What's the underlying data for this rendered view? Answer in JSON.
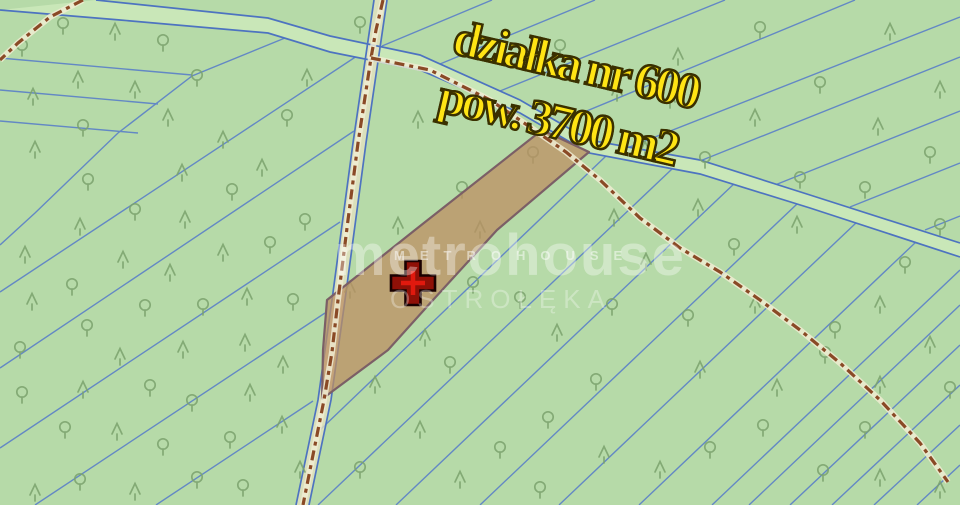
{
  "canvas": {
    "width": 960,
    "height": 505
  },
  "labels": {
    "parcel_number": "działka nr 600",
    "parcel_area": "pow. 3700 m2"
  },
  "watermark": {
    "brand": "metrohouse",
    "brand_small": "METROHOUSE",
    "city": "OSTROŁĘKA"
  },
  "colors": {
    "ground": "#b6daa8",
    "boundary_line": "#5b80c8",
    "road_edge": "#4d73c0",
    "road_fill": "#c9e7b8",
    "path_fill": "#e6e2c2",
    "dash_backing": "#f0ecd2",
    "dash": "#8a4a26",
    "tree": "#7ba26d",
    "parcel_fill": "#bc8f63",
    "parcel_border": "#7b5f66",
    "marker_fill": "#8f1007",
    "marker_inner": "#e0190e",
    "marker_outline": "#190000",
    "label_yellow": "#ffe414",
    "label_outline": "#3a3000"
  },
  "map": {
    "boundary_lines": [
      [
        [
          0,
          58
        ],
        [
          192,
          75
        ]
      ],
      [
        [
          0,
          90
        ],
        [
          158,
          104
        ]
      ],
      [
        [
          0,
          121
        ],
        [
          138,
          133
        ]
      ],
      [
        [
          285,
          38
        ],
        [
          192,
          76
        ],
        [
          118,
          133
        ],
        [
          35,
          213
        ],
        [
          0,
          245
        ]
      ],
      [
        [
          366,
          50
        ],
        [
          0,
          292
        ]
      ],
      [
        [
          354,
          131
        ],
        [
          0,
          368
        ]
      ],
      [
        [
          340,
          222
        ],
        [
          0,
          448
        ]
      ],
      [
        [
          325,
          313
        ],
        [
          35,
          505
        ]
      ],
      [
        [
          313,
          401
        ],
        [
          156,
          505
        ]
      ],
      [
        [
          606,
          156
        ],
        [
          320,
          430
        ]
      ],
      [
        [
          672,
          169
        ],
        [
          318,
          505
        ]
      ],
      [
        [
          737,
          181
        ],
        [
          396,
          505
        ]
      ],
      [
        [
          797,
          204
        ],
        [
          480,
          505
        ]
      ],
      [
        [
          857,
          222
        ],
        [
          559,
          505
        ]
      ],
      [
        [
          917,
          241
        ],
        [
          639,
          505
        ]
      ],
      [
        [
          960,
          270
        ],
        [
          712,
          505
        ]
      ],
      [
        [
          960,
          305
        ],
        [
          749,
          505
        ]
      ],
      [
        [
          960,
          345
        ],
        [
          790,
          505
        ]
      ],
      [
        [
          960,
          385
        ],
        [
          832,
          505
        ]
      ],
      [
        [
          960,
          425
        ],
        [
          874,
          505
        ]
      ],
      [
        [
          960,
          465
        ],
        [
          917,
          505
        ]
      ],
      [
        [
          382,
          46
        ],
        [
          492,
          0
        ]
      ],
      [
        [
          440,
          64
        ],
        [
          595,
          0
        ]
      ],
      [
        [
          500,
          91
        ],
        [
          725,
          0
        ]
      ],
      [
        [
          560,
          122
        ],
        [
          855,
          0
        ]
      ],
      [
        [
          627,
          148
        ],
        [
          960,
          17
        ]
      ],
      [
        [
          700,
          161
        ],
        [
          960,
          57
        ]
      ],
      [
        [
          775,
          185
        ],
        [
          960,
          111
        ]
      ],
      [
        [
          850,
          207
        ],
        [
          960,
          163
        ]
      ],
      [
        [
          925,
          230
        ],
        [
          960,
          216
        ]
      ]
    ],
    "roads": {
      "main": {
        "upper": [
          [
            96,
            0
          ],
          [
            268,
            18
          ],
          [
            330,
            36
          ],
          [
            420,
            55
          ],
          [
            520,
            100
          ],
          [
            589,
            140
          ],
          [
            700,
            160
          ],
          [
            810,
            195
          ],
          [
            960,
            243
          ]
        ],
        "lower": [
          [
            0,
            10
          ],
          [
            120,
            20
          ],
          [
            268,
            33
          ],
          [
            330,
            52
          ],
          [
            420,
            70
          ],
          [
            520,
            113
          ],
          [
            589,
            153
          ],
          [
            700,
            174
          ],
          [
            810,
            208
          ],
          [
            960,
            257
          ]
        ]
      },
      "path": {
        "left": [
          [
            374,
            0
          ],
          [
            353,
            143
          ],
          [
            332,
            300
          ],
          [
            318,
            400
          ],
          [
            296,
            505
          ]
        ],
        "right": [
          [
            387,
            0
          ],
          [
            366,
            143
          ],
          [
            345,
            300
          ],
          [
            331,
            400
          ],
          [
            309,
            505
          ]
        ]
      }
    },
    "dashed_paths": [
      [
        [
          383,
          0
        ],
        [
          376,
          30
        ],
        [
          371,
          58
        ],
        [
          358,
          143
        ],
        [
          348,
          220
        ],
        [
          338,
          300
        ],
        [
          332,
          352
        ],
        [
          324,
          400
        ],
        [
          312,
          460
        ],
        [
          303,
          505
        ]
      ],
      [
        [
          371,
          58
        ],
        [
          430,
          70
        ],
        [
          490,
          100
        ],
        [
          530,
          127
        ],
        [
          566,
          152
        ],
        [
          600,
          180
        ],
        [
          640,
          218
        ],
        [
          680,
          248
        ],
        [
          720,
          272
        ],
        [
          760,
          300
        ],
        [
          800,
          330
        ],
        [
          840,
          363
        ],
        [
          880,
          400
        ],
        [
          920,
          443
        ],
        [
          948,
          482
        ]
      ],
      [
        [
          83,
          0
        ],
        [
          50,
          17
        ],
        [
          18,
          43
        ],
        [
          0,
          60
        ]
      ]
    ],
    "parcel": {
      "points": [
        [
          542,
          130
        ],
        [
          589,
          152
        ],
        [
          497,
          230
        ],
        [
          433,
          300
        ],
        [
          388,
          350
        ],
        [
          322,
          399
        ],
        [
          323,
          350
        ],
        [
          327,
          300
        ],
        [
          415,
          230
        ]
      ],
      "marker": {
        "x": 413,
        "y": 283
      }
    },
    "trees": [
      [
        115,
        32,
        "c"
      ],
      [
        163,
        43,
        "d"
      ],
      [
        22,
        48,
        "d"
      ],
      [
        63,
        26,
        "d"
      ],
      [
        78,
        80,
        "c"
      ],
      [
        33,
        97,
        "c"
      ],
      [
        135,
        90,
        "c"
      ],
      [
        197,
        78,
        "d"
      ],
      [
        83,
        128,
        "d"
      ],
      [
        168,
        118,
        "c"
      ],
      [
        35,
        150,
        "c"
      ],
      [
        223,
        140,
        "c"
      ],
      [
        182,
        173,
        "c"
      ],
      [
        88,
        182,
        "d"
      ],
      [
        135,
        212,
        "d"
      ],
      [
        232,
        192,
        "d"
      ],
      [
        80,
        227,
        "c"
      ],
      [
        185,
        220,
        "c"
      ],
      [
        287,
        118,
        "d"
      ],
      [
        262,
        168,
        "c"
      ],
      [
        305,
        222,
        "d"
      ],
      [
        307,
        78,
        "c"
      ],
      [
        360,
        25,
        "d"
      ],
      [
        25,
        255,
        "c"
      ],
      [
        123,
        260,
        "c"
      ],
      [
        170,
        273,
        "c"
      ],
      [
        72,
        287,
        "d"
      ],
      [
        223,
        253,
        "c"
      ],
      [
        270,
        245,
        "d"
      ],
      [
        32,
        302,
        "c"
      ],
      [
        145,
        308,
        "d"
      ],
      [
        203,
        307,
        "d"
      ],
      [
        247,
        297,
        "c"
      ],
      [
        293,
        302,
        "d"
      ],
      [
        87,
        328,
        "d"
      ],
      [
        120,
        357,
        "c"
      ],
      [
        183,
        350,
        "c"
      ],
      [
        245,
        343,
        "c"
      ],
      [
        20,
        350,
        "d"
      ],
      [
        22,
        395,
        "d"
      ],
      [
        83,
        390,
        "c"
      ],
      [
        150,
        388,
        "d"
      ],
      [
        192,
        403,
        "d"
      ],
      [
        250,
        393,
        "c"
      ],
      [
        283,
        365,
        "c"
      ],
      [
        65,
        430,
        "d"
      ],
      [
        117,
        432,
        "c"
      ],
      [
        163,
        447,
        "d"
      ],
      [
        230,
        440,
        "d"
      ],
      [
        282,
        425,
        "c"
      ],
      [
        35,
        493,
        "c"
      ],
      [
        80,
        482,
        "d"
      ],
      [
        135,
        492,
        "c"
      ],
      [
        197,
        480,
        "d"
      ],
      [
        243,
        488,
        "d"
      ],
      [
        300,
        470,
        "c"
      ],
      [
        418,
        120,
        "c"
      ],
      [
        462,
        190,
        "d"
      ],
      [
        398,
        226,
        "c"
      ],
      [
        350,
        290,
        "c"
      ],
      [
        533,
        155,
        "d"
      ],
      [
        480,
        230,
        "c"
      ],
      [
        425,
        338,
        "c"
      ],
      [
        450,
        365,
        "d"
      ],
      [
        375,
        385,
        "c"
      ],
      [
        473,
        285,
        "d"
      ],
      [
        520,
        300,
        "d"
      ],
      [
        557,
        333,
        "c"
      ],
      [
        596,
        382,
        "d"
      ],
      [
        548,
        420,
        "d"
      ],
      [
        500,
        450,
        "d"
      ],
      [
        460,
        480,
        "c"
      ],
      [
        540,
        490,
        "d"
      ],
      [
        420,
        430,
        "c"
      ],
      [
        360,
        470,
        "d"
      ],
      [
        604,
        455,
        "c"
      ],
      [
        560,
        48,
        "d"
      ],
      [
        617,
        93,
        "c"
      ],
      [
        678,
        57,
        "c"
      ],
      [
        760,
        30,
        "d"
      ],
      [
        820,
        85,
        "d"
      ],
      [
        890,
        32,
        "c"
      ],
      [
        940,
        90,
        "c"
      ],
      [
        878,
        127,
        "c"
      ],
      [
        930,
        155,
        "d"
      ],
      [
        670,
        100,
        "c"
      ],
      [
        645,
        150,
        "c"
      ],
      [
        705,
        160,
        "d"
      ],
      [
        755,
        118,
        "c"
      ],
      [
        800,
        180,
        "d"
      ],
      [
        865,
        190,
        "d"
      ],
      [
        940,
        227,
        "d"
      ],
      [
        614,
        218,
        "c"
      ],
      [
        698,
        208,
        "c"
      ],
      [
        797,
        225,
        "c"
      ],
      [
        734,
        247,
        "d"
      ],
      [
        646,
        262,
        "c"
      ],
      [
        612,
        307,
        "d"
      ],
      [
        688,
        318,
        "d"
      ],
      [
        755,
        305,
        "c"
      ],
      [
        835,
        330,
        "d"
      ],
      [
        905,
        265,
        "d"
      ],
      [
        880,
        305,
        "c"
      ],
      [
        930,
        345,
        "c"
      ],
      [
        700,
        370,
        "c"
      ],
      [
        825,
        355,
        "d"
      ],
      [
        777,
        388,
        "c"
      ],
      [
        880,
        385,
        "c"
      ],
      [
        763,
        428,
        "d"
      ],
      [
        865,
        430,
        "d"
      ],
      [
        950,
        390,
        "d"
      ],
      [
        823,
        473,
        "d"
      ],
      [
        880,
        478,
        "c"
      ],
      [
        940,
        490,
        "c"
      ],
      [
        660,
        470,
        "c"
      ],
      [
        710,
        450,
        "d"
      ]
    ]
  }
}
